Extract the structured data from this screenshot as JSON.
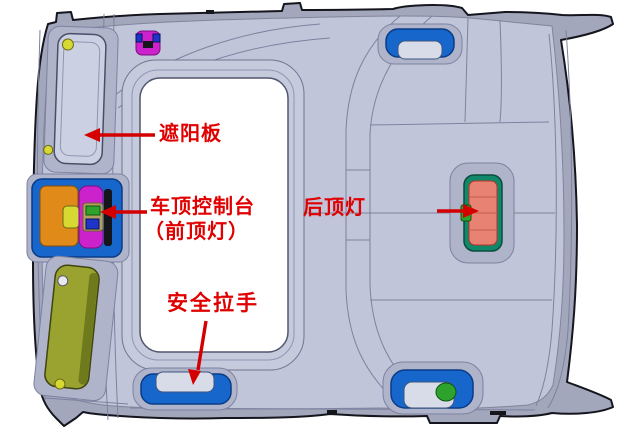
{
  "labels": {
    "sun_visor": "遮阳板",
    "roof_console": "车顶控制台",
    "roof_console_sub": "（前顶灯）",
    "rear_dome_light": "后顶灯",
    "safety_grab_handle": "安全拉手"
  },
  "colors": {
    "background": "#ffffff",
    "label_red": "#e00000",
    "arrow_red": "#d40000",
    "headliner_base": "#c1c5da",
    "headliner_trim": "#a2a7bb",
    "line": "#7d82a0",
    "component_blue": "#1766cc",
    "component_orange": "#e08a1a",
    "component_magenta": "#cc22cc",
    "visor_olive": "#9aa32f",
    "lamp_teal": "#11886a",
    "lamp_lens_salmon": "#e88273",
    "accent_green": "#2da32d",
    "accent_yellow": "#d8d832"
  }
}
